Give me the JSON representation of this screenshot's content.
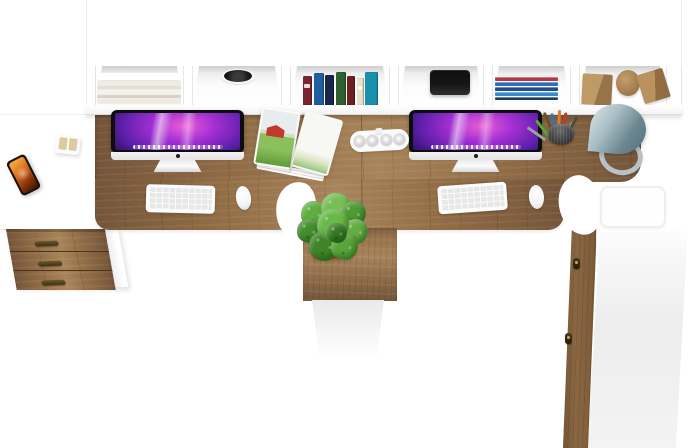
{
  "meta": {
    "title": "White and oak double computer workstation - top view product render",
    "description": "Top-down 3D product render of a white and rustic-oak double computer workstation on a pure white background. A white wall hutch with six open cubbies holds a stack of magazines, a cable grommet hole, a row of standing books, a black speaker, a stack of flat blue books and wooden cube and cylinder bookends. The shared oak desktop carries two black-bezel all-in-one computers showing a purple galaxy wallpaper, two white keyboards and mice, an open magazine with a red barn photo, a white modular power strip, a dark mesh pencil cup with colored pens and a silver cone desk lamp with ring base. A green plant in a red pot sits on the centre oak column above a white cabinet. On the left a white return desk holds a phone with a flame wallpaper and a small beige desk organizer above an oak three-drawer pedestal; a tall oak-front wardrobe cabinet with two small handles closes the right side."
  },
  "colors": {
    "bg": "#ffffff",
    "panel-white": "#fdfdfd",
    "edge": "#e8e8e8",
    "wood": "#916d46",
    "wood-dark": "#74553a",
    "wood-light": "#a8845a",
    "drawer-seam": "#4a3316",
    "handle": "#473a1d",
    "bezel": "#0d0d0d",
    "chin": "#f2f2f2",
    "wp-pink": "#e95fd4",
    "wp-purple": "#a32fd4",
    "wp-violet": "#5b1fa8",
    "wp-deep": "#1c0a45",
    "keyboard": "#e7e7e7",
    "mouse": "#f4f4f4",
    "pot": "#c2402a",
    "plant": "#4f9a33",
    "lamp-light": "#dce4e6",
    "lamp-dark": "#52707a",
    "phone-body": "#1a120c",
    "flame": "#d96a1a",
    "speaker": "#101010",
    "accent-orange": "#e8611c",
    "accent-blue": "#2b6cb8",
    "barn-red": "#c0392b",
    "grass": "#6fae49",
    "sky": "#e7edef"
  },
  "hutch": {
    "compartments": [
      {
        "content": "magazine stack"
      },
      {
        "content": "cable grommet hole"
      },
      {
        "content": "standing books"
      },
      {
        "content": "black speaker"
      },
      {
        "content": "flat blue book stack"
      },
      {
        "content": "wooden cube and cylinder bookends"
      }
    ]
  },
  "magazine_stack": [
    {
      "c": "#ffffff",
      "h": 8
    },
    {
      "c": "#efece3",
      "h": 4
    },
    {
      "c": "#e4dfd2",
      "h": 4
    },
    {
      "c": "#f4f2eb",
      "h": 4
    },
    {
      "c": "#d9d3c5",
      "h": 4
    },
    {
      "c": "#eeeae0",
      "h": 4
    }
  ],
  "standing_books": [
    {
      "c": "#7a2433",
      "w": 9,
      "h": 29
    },
    {
      "c": "#1f5fa0",
      "w": 10,
      "h": 32
    },
    {
      "c": "#18264e",
      "w": 9,
      "h": 30
    },
    {
      "c": "#2e6030",
      "w": 10,
      "h": 33
    },
    {
      "c": "#6e2020",
      "w": 8,
      "h": 29
    },
    {
      "c": "#e9e1cb",
      "w": 7,
      "h": 27
    },
    {
      "c": "#1a8fae",
      "w": 13,
      "h": 33
    }
  ],
  "flat_books": [
    {
      "c": "#b23a48",
      "h": 5
    },
    {
      "c": "#2f6db5",
      "h": 5
    },
    {
      "c": "#1d4f8c",
      "h": 4
    },
    {
      "c": "#3c89c9",
      "h": 5
    },
    {
      "c": "#173f70",
      "h": 4
    }
  ],
  "pens": [
    {
      "c": "#5aa53a",
      "x": 3,
      "y": 8,
      "h": 20,
      "r": -38
    },
    {
      "c": "#c23a2e",
      "x": 16,
      "y": 4,
      "h": 19,
      "r": 14
    },
    {
      "c": "#2f74b5",
      "x": 10,
      "y": 5,
      "h": 18,
      "r": -12
    },
    {
      "c": "#e0b32c",
      "x": 21,
      "y": 9,
      "h": 14,
      "r": 38
    },
    {
      "c": "#9aa0a4",
      "x": 0,
      "y": 10,
      "h": 22,
      "r": -55
    },
    {
      "c": "#d57f2a",
      "x": 13,
      "y": 2,
      "h": 17,
      "r": 4
    },
    {
      "c": "#4a4a4a",
      "x": 24,
      "y": 7,
      "h": 15,
      "r": 30
    },
    {
      "c": "#6b4e2e",
      "x": 6,
      "y": 3,
      "h": 18,
      "r": -24
    }
  ],
  "plant_blobs": [
    {
      "c": "#5fae3f",
      "x": 4,
      "y": 8,
      "s": 26
    },
    {
      "c": "#77bf55",
      "x": 24,
      "y": 0,
      "s": 30
    },
    {
      "c": "#4f9a33",
      "x": 44,
      "y": 8,
      "s": 25
    },
    {
      "c": "#468e2d",
      "x": 0,
      "y": 26,
      "s": 24
    },
    {
      "c": "#63ad43",
      "x": 46,
      "y": 26,
      "s": 25
    },
    {
      "c": "#3f8527",
      "x": 12,
      "y": 38,
      "s": 30
    },
    {
      "c": "#58a53a",
      "x": 34,
      "y": 40,
      "s": 27
    },
    {
      "c": "#6ab84a",
      "x": 20,
      "y": 16,
      "s": 32
    },
    {
      "c": "#357a22",
      "x": 30,
      "y": 30,
      "s": 20
    }
  ],
  "drawers": [
    {},
    {},
    {}
  ],
  "wardrobe_handles": [
    {
      "x": 573,
      "y": 258
    },
    {
      "x": 565,
      "y": 333
    }
  ],
  "power_strip_sockets": [
    {
      "x": 3
    },
    {
      "x": 16
    },
    {
      "x": 30
    },
    {
      "x": 43
    }
  ],
  "workstations": [
    {
      "computer": "all-in-one desktop",
      "wallpaper": "purple galaxy",
      "keyboard": "white",
      "mouse": "white"
    },
    {
      "computer": "all-in-one desktop",
      "wallpaper": "purple galaxy",
      "keyboard": "white",
      "mouse": "white"
    }
  ]
}
